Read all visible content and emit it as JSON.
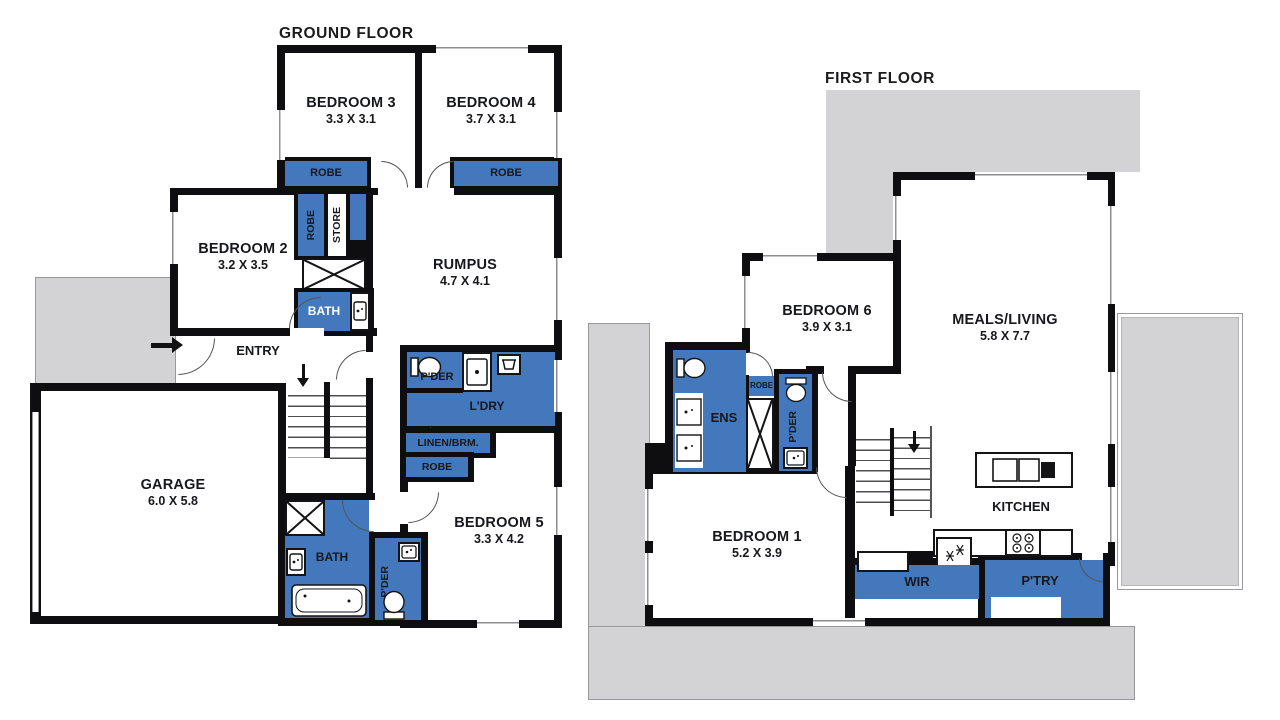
{
  "colors": {
    "wet_area_blue": "#4478BD",
    "outdoor_gray": "#D3D3D5",
    "wall_black": "#0E0E10",
    "text_black": "#17181B"
  },
  "ground_floor": {
    "title": "GROUND FLOOR",
    "rooms": {
      "bedroom3": {
        "name": "BEDROOM 3",
        "dims": "3.3 X 3.1"
      },
      "bedroom4": {
        "name": "BEDROOM 4",
        "dims": "3.7 X 3.1"
      },
      "bedroom2": {
        "name": "BEDROOM 2",
        "dims": "3.2 X 3.5"
      },
      "rumpus": {
        "name": "RUMPUS",
        "dims": "4.7 X 4.1"
      },
      "garage": {
        "name": "GARAGE",
        "dims": "6.0 X 5.8"
      },
      "bedroom5": {
        "name": "BEDROOM 5",
        "dims": "3.3 X 4.2"
      }
    },
    "labels": {
      "entry": "ENTRY",
      "robe_bed3": "ROBE",
      "robe_bed4": "ROBE",
      "robe_hall": "ROBE",
      "store": "STORE",
      "bath_upper": "BATH",
      "pder_laundry": "P'DER",
      "laundry": "L'DRY",
      "linen": "LINEN/BRM.",
      "robe_bed5": "ROBE",
      "bath_lower": "BATH",
      "pder_rear": "P'DER"
    }
  },
  "first_floor": {
    "title": "FIRST FLOOR",
    "rooms": {
      "bedroom6": {
        "name": "BEDROOM 6",
        "dims": "3.9 X 3.1"
      },
      "meals_living": {
        "name": "MEALS/LIVING",
        "dims": "5.8 X 7.7"
      },
      "bedroom1": {
        "name": "BEDROOM 1",
        "dims": "5.2 X 3.9"
      },
      "kitchen": {
        "name": "KITCHEN"
      }
    },
    "labels": {
      "ens": "ENS",
      "robe": "ROBE",
      "pder": "P'DER",
      "wir": "WIR",
      "pantry": "P'TRY"
    }
  }
}
